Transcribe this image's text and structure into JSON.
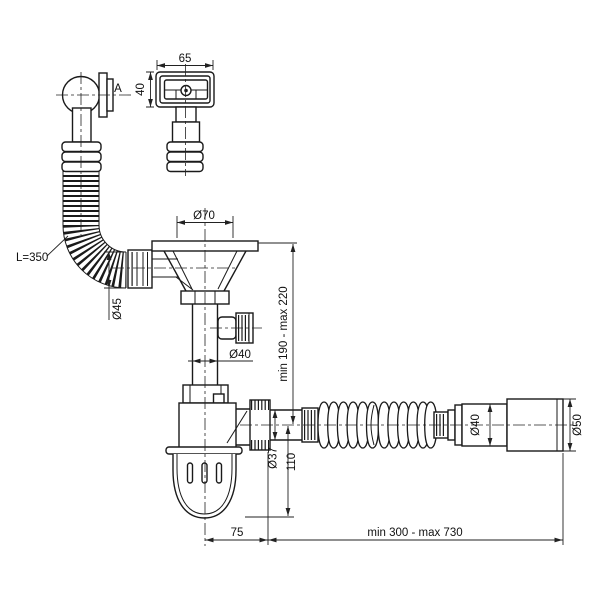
{
  "drawing": {
    "background": "#ffffff",
    "line_color": "#1a1a1a",
    "labels": {
      "overflow_view_label": "A",
      "plate_width": "65",
      "plate_height": "40",
      "hose_length": "L=350",
      "funnel_top_diameter": "Ø70",
      "hose_nut_diameter": "Ø45",
      "inlet_height_range": "min 190 - max 220",
      "tailpipe_diameter": "Ø40",
      "trap_outlet_diameter": "Ø37",
      "trap_bottom_depth": "110",
      "outlet_pipe_diameter": "Ø40",
      "outlet_sleeve_diameter": "Ø50",
      "trap_horizontal_offset": "75",
      "flexible_length_range": "min 300 - max 730"
    }
  }
}
